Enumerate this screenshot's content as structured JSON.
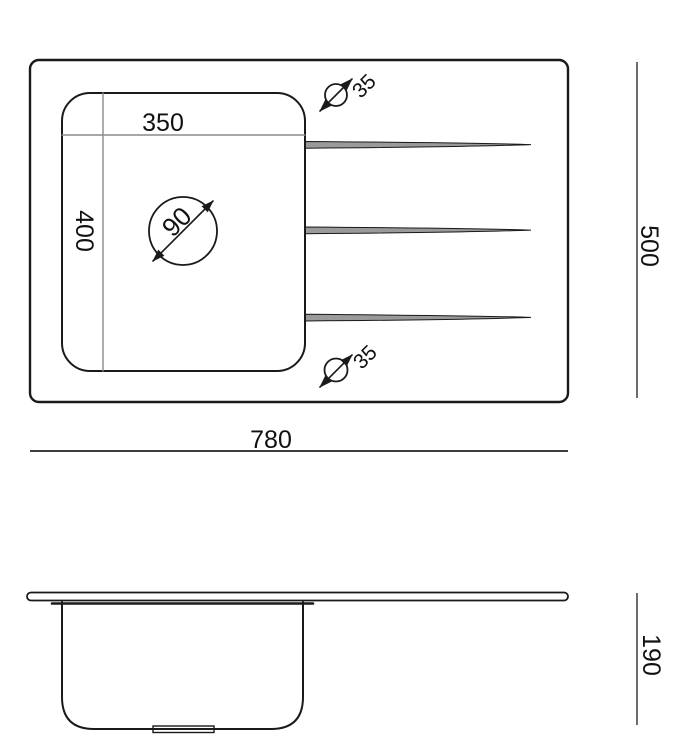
{
  "drawing": {
    "type": "sink-technical-drawing",
    "views": {
      "top_view": "plan view of sink with bowl, drain, tap holes and drainer grooves",
      "side_view": "front elevation of sink bowl under countertop rim"
    },
    "dimensions": {
      "bowl_width": "350",
      "bowl_depth": "400",
      "drain_diameter": "90",
      "tap_hole_top_diameter": "35",
      "tap_hole_bottom_diameter": "35",
      "overall_width": "780",
      "overall_depth": "500",
      "bowl_height": "190"
    },
    "symbols": {
      "diameter_symbol": "circle-with-double-arrow-slash"
    },
    "counts": {
      "drainer_grooves": 3,
      "tap_holes": 2
    },
    "colors": {
      "background": "#ffffff",
      "line": "#1a1a1a",
      "dim_line": "#8a8a8a",
      "dim_line_dark": "#3d3d3d",
      "text": "#111111",
      "groove_fill": "#9a9a9a"
    }
  }
}
